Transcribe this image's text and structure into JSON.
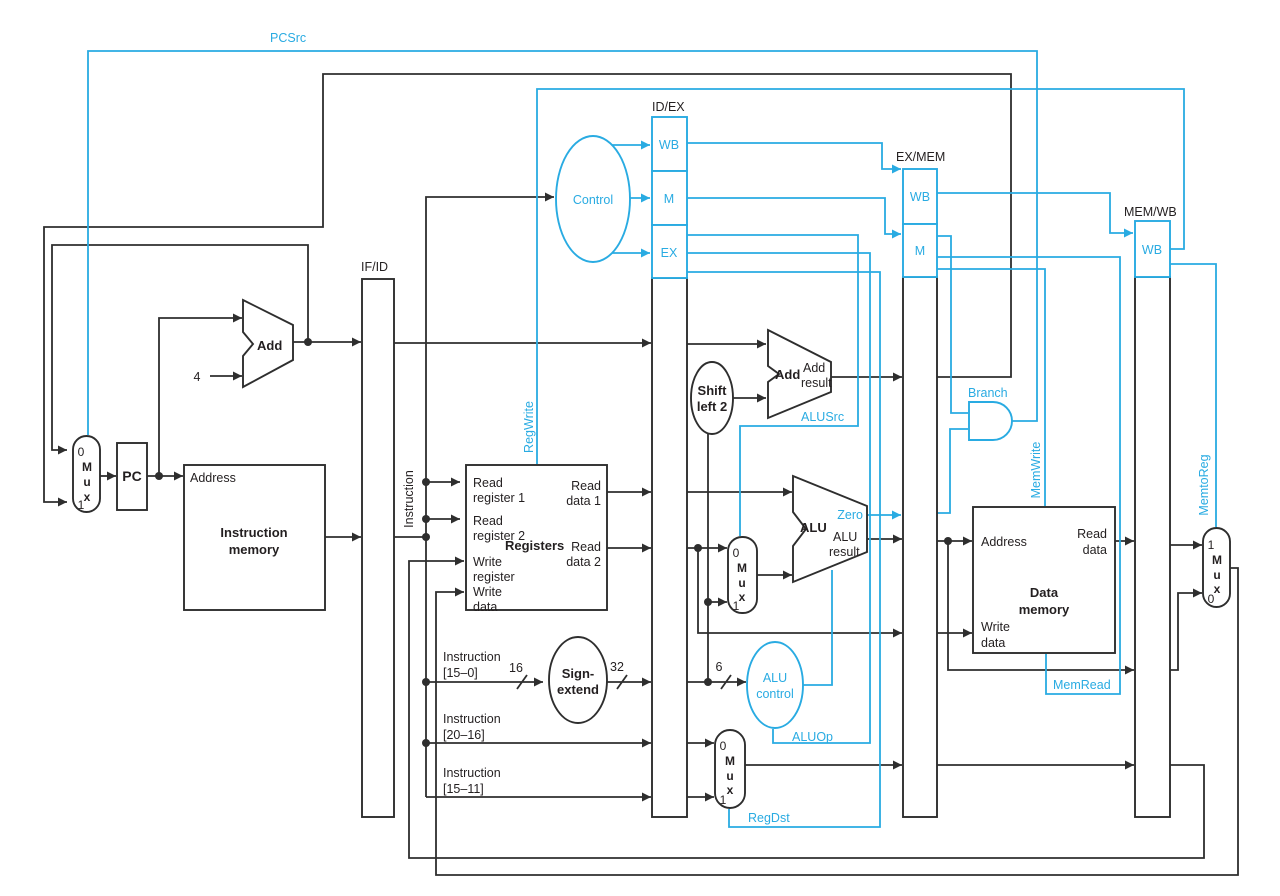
{
  "colors": {
    "accent": "#29abe2",
    "line": "#2e2e2e",
    "background": "#ffffff"
  },
  "pipeline": {
    "ifid": "IF/ID",
    "idex": "ID/EX",
    "exmem": "EX/MEM",
    "memwb": "MEM/WB",
    "wb": "WB",
    "m": "M",
    "ex": "EX"
  },
  "signals": {
    "pcsrc": "PCSrc",
    "regwrite": "RegWrite",
    "alusrc": "ALUSrc",
    "aluop": "ALUOp",
    "regdst": "RegDst",
    "branch": "Branch",
    "memwrite": "MemWrite",
    "memread": "MemRead",
    "memtoreg": "MemtoReg",
    "zero": "Zero"
  },
  "units": {
    "pc": "PC",
    "control": "Control",
    "add": "Add",
    "add_result_1": "Add",
    "add_result_2": "result",
    "alu": "ALU",
    "alu_result_1": "ALU",
    "alu_result_2": "result",
    "alu_control_1": "ALU",
    "alu_control_2": "control",
    "sign_extend_1": "Sign-",
    "sign_extend_2": "extend",
    "shift_1": "Shift",
    "shift_2": "left 2",
    "imem_1": "Instruction",
    "imem_2": "memory",
    "dmem_1": "Data",
    "dmem_2": "memory",
    "registers": "Registers"
  },
  "ports": {
    "address": "Address",
    "read": "Read",
    "write": "Write",
    "data": "data",
    "register_1": "register 1",
    "register_2": "register 2",
    "register": "register",
    "data_1": "data 1",
    "data_2": "data 2",
    "instruction": "Instruction"
  },
  "buses": {
    "instr": "Instruction",
    "r15_0": "[15–0]",
    "r20_16": "[20–16]",
    "r15_11": "[15–11]",
    "w16": "16",
    "w32": "32",
    "w6": "6",
    "four": "4"
  },
  "mux": {
    "m": "M",
    "u": "u",
    "x": "x",
    "zero": "0",
    "one": "1"
  }
}
